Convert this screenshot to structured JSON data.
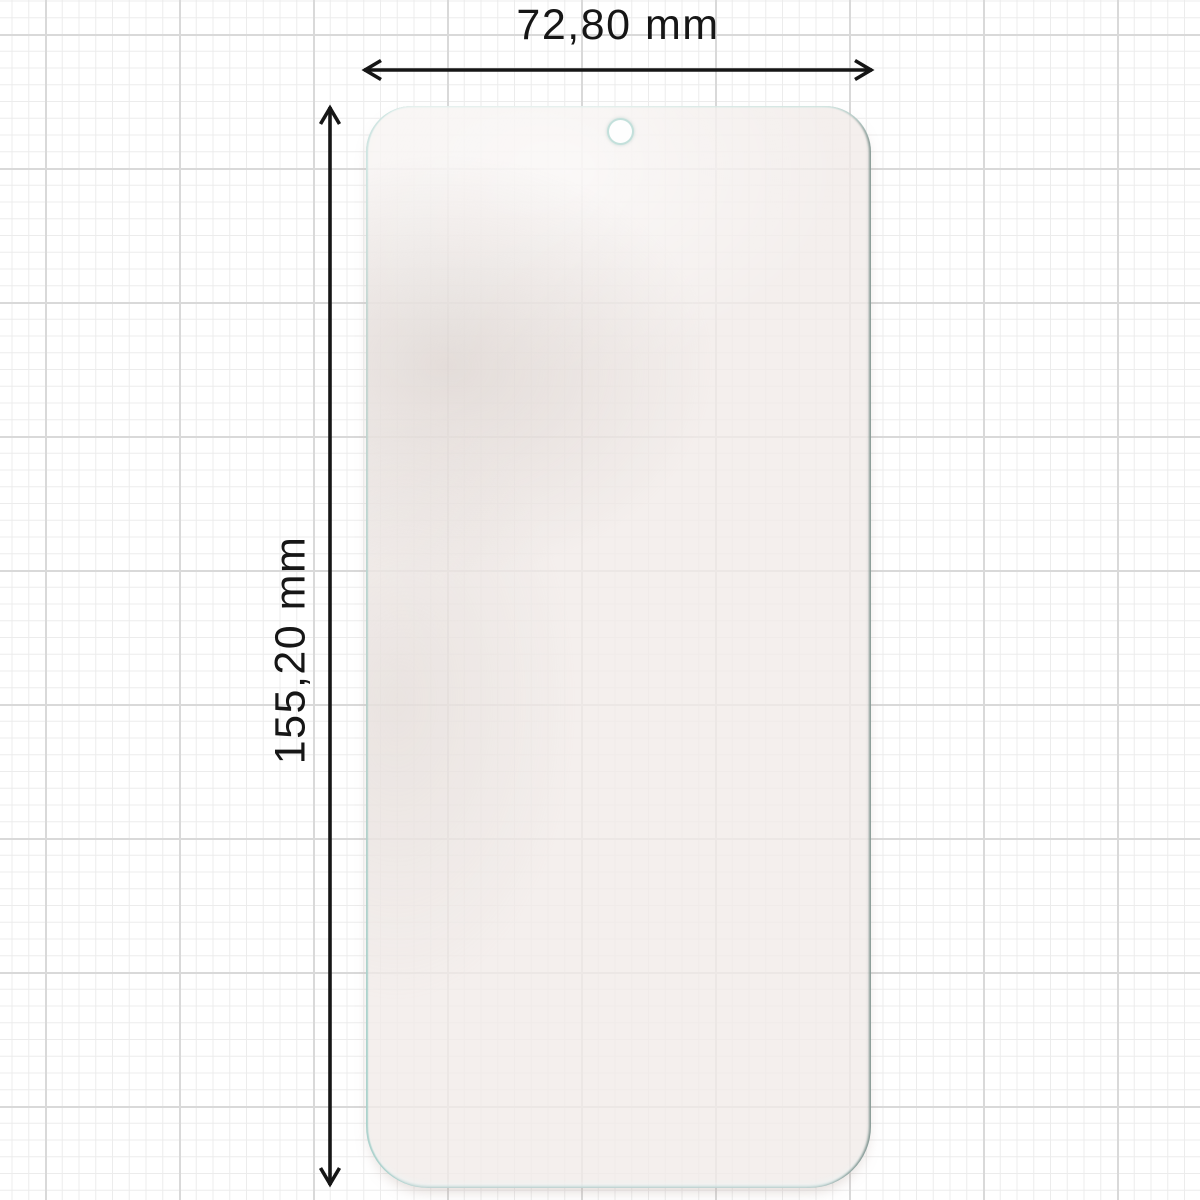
{
  "diagram": {
    "subject": "tempered-glass-screen-protector",
    "width_dimension": {
      "label": "72,80 mm",
      "value": "72,80",
      "unit": "mm"
    },
    "height_dimension": {
      "label": "155,20 mm",
      "value": "155,20",
      "unit": "mm"
    },
    "features": {
      "camera_hole": "top-center"
    }
  },
  "colors": {
    "background": "#ffffff",
    "grid_minor": "#ececec",
    "grid_major": "#d9d9d9",
    "dimension_line": "#161616",
    "label_text": "#161616",
    "glass_tint": "#f1eae8",
    "glass_edge_teal": "#aed3cd",
    "glass_edge_dark": "#7e918b"
  }
}
